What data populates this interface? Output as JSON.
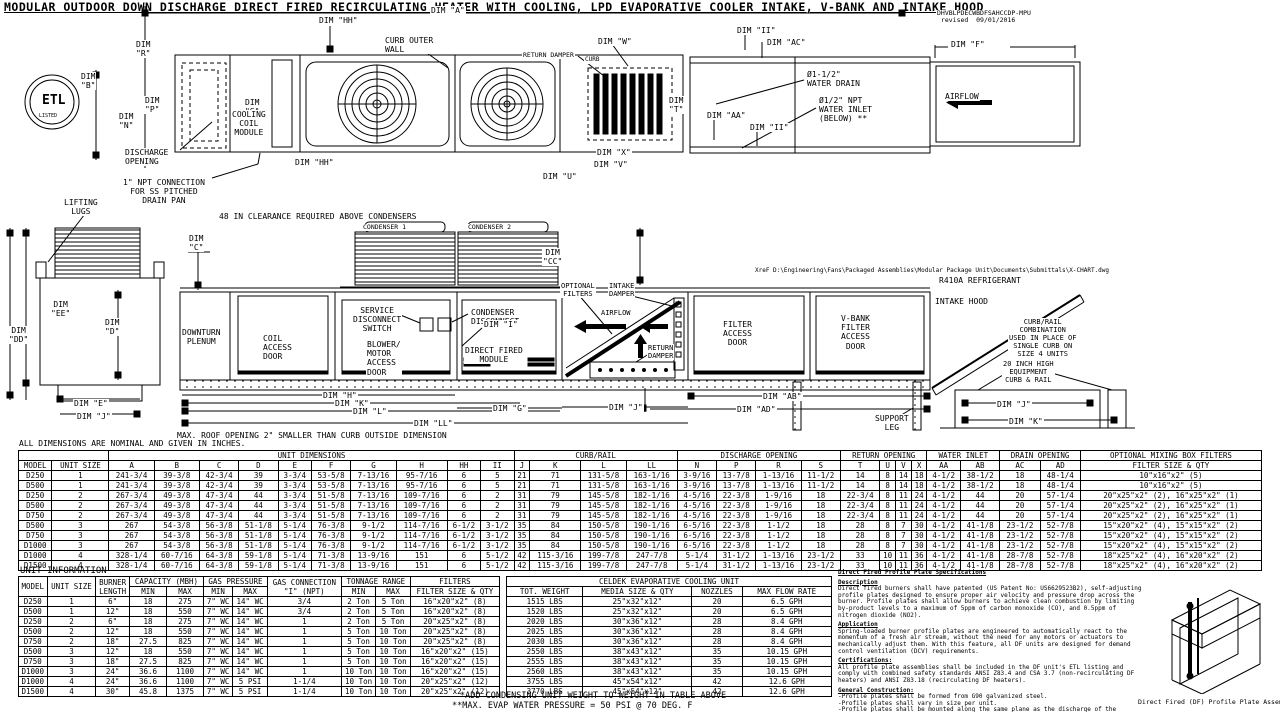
{
  "title": "MODULAR OUTDOOR DOWN DISCHARGE DIRECT FIRED RECIRCULATING HEATER WITH COOLING, LPD EVAPORATIVE COOLER INTAKE, V-BANK AND INTAKE HOOD",
  "labels": [
    {
      "k": "drawing-number",
      "t": "DHVBLPDECWBDFSAHCCDP-MPU\n revised  09/01/2016",
      "x": 936,
      "y": 10,
      "fs": 6.5
    },
    {
      "k": "dim-hh-top-label",
      "t": "DIM \"HH\"",
      "x": 318,
      "y": 16
    },
    {
      "k": "dim-a-label",
      "t": "DIM \"A\"",
      "x": 430,
      "y": 6
    },
    {
      "k": "curb-outer-wall-label",
      "t": "CURB OUTER\nWALL",
      "x": 384,
      "y": 36
    },
    {
      "k": "return-damper-plan-label",
      "t": "RETURN DAMPER",
      "x": 522,
      "y": 52,
      "fs": 6.5
    },
    {
      "k": "curb-small-label",
      "t": "CURB",
      "x": 584,
      "y": 57,
      "fs": 6
    },
    {
      "k": "dim-w-label",
      "t": "DIM \"W\"",
      "x": 597,
      "y": 37
    },
    {
      "k": "dim-r-label",
      "c": "ctr",
      "t": "DIM\n\"R\"",
      "x": 135,
      "y": 40
    },
    {
      "k": "dim-b-label",
      "c": "ctr",
      "t": "DIM\n\"B\"",
      "x": 80,
      "y": 72
    },
    {
      "k": "dim-s-label",
      "c": "ctr",
      "t": "DIM\n\"S\"",
      "x": 244,
      "y": 98
    },
    {
      "k": "dim-p-label",
      "c": "ctr",
      "t": "DIM\n\"P\"",
      "x": 144,
      "y": 96
    },
    {
      "k": "dim-n-label",
      "c": "ctr",
      "t": "DIM\n\"N\"",
      "x": 118,
      "y": 112
    },
    {
      "k": "cooling-coil-module-label",
      "c": "ctr",
      "t": "COOLING\nCOIL\nMODULE",
      "x": 231,
      "y": 110
    },
    {
      "k": "discharge-opening-label",
      "t": "DISCHARGE\nOPENING",
      "x": 124,
      "y": 148
    },
    {
      "k": "dim-hh-mid-label",
      "t": "DIM \"HH\"",
      "x": 294,
      "y": 158
    },
    {
      "k": "npt-connection-label",
      "c": "ctr",
      "t": "1\" NPT CONNECTION\nFOR SS PITCHED\nDRAIN PAN",
      "x": 122,
      "y": 178
    },
    {
      "k": "dim-t-label",
      "c": "ctr",
      "t": "DIM\n\"T\"",
      "x": 668,
      "y": 96
    },
    {
      "k": "dim-x-label",
      "t": "DIM \"X\"",
      "x": 596,
      "y": 148
    },
    {
      "k": "dim-v-label",
      "t": "DIM \"V\"",
      "x": 593,
      "y": 160
    },
    {
      "k": "dim-u-label",
      "t": "DIM \"U\"",
      "x": 542,
      "y": 172
    },
    {
      "k": "dim-ii-1-label",
      "t": "DIM \"II\"",
      "x": 736,
      "y": 26
    },
    {
      "k": "dim-ac-label",
      "t": "DIM \"AC\"",
      "x": 766,
      "y": 38
    },
    {
      "k": "water-drain-label",
      "t": "Ø1-1/2\"\nWATER DRAIN",
      "x": 806,
      "y": 70
    },
    {
      "k": "water-inlet-label",
      "t": "Ø1/2\" NPT\nWATER INLET\n(BELOW) **",
      "x": 818,
      "y": 96
    },
    {
      "k": "dim-aa-label",
      "t": "DIM \"AA\"",
      "x": 706,
      "y": 111
    },
    {
      "k": "dim-ii-2-label",
      "t": "DIM \"II\"",
      "x": 749,
      "y": 123
    },
    {
      "k": "dim-f-label",
      "t": "DIM \"F\"",
      "x": 950,
      "y": 40
    },
    {
      "k": "airflow-plan-label",
      "t": "AIRFLOW",
      "x": 944,
      "y": 92
    },
    {
      "k": "etl-mark-text",
      "c": "ctr nobg b",
      "t": "ETL",
      "x": 41,
      "y": 94,
      "fs": 13
    },
    {
      "k": "etl-listed-text",
      "c": "ctr nobg",
      "t": "LISTED",
      "x": 38,
      "y": 114,
      "fs": 5
    },
    {
      "k": "lifting-lugs-label",
      "c": "ctr",
      "t": "LIFTING\nLUGS",
      "x": 63,
      "y": 198
    },
    {
      "k": "clearance-note",
      "t": "48 IN CLEARANCE REQUIRED ABOVE CONDENSERS",
      "x": 218,
      "y": 212
    },
    {
      "k": "condenser-1-label",
      "t": "CONDENSER 1",
      "x": 362,
      "y": 224,
      "fs": 6.5
    },
    {
      "k": "condenser-2-label",
      "t": "CONDENSER 2",
      "x": 467,
      "y": 224,
      "fs": 6.5
    },
    {
      "k": "dim-c-label",
      "c": "ctr",
      "t": "DIM\n\"C\"",
      "x": 188,
      "y": 234
    },
    {
      "k": "dim-cc-label",
      "c": "ctr",
      "t": "DIM\n\"CC\"",
      "x": 542,
      "y": 248
    },
    {
      "k": "dim-ee-label",
      "c": "ctr",
      "t": "DIM\n\"EE\"",
      "x": 50,
      "y": 300
    },
    {
      "k": "dim-dd-label",
      "c": "ctr",
      "t": "DIM\n\"DD\"",
      "x": 8,
      "y": 326
    },
    {
      "k": "dim-d-label",
      "c": "ctr",
      "t": "DIM\n\"D\"",
      "x": 104,
      "y": 318
    },
    {
      "k": "downturn-plenum-label",
      "c": "ctr",
      "t": "DOWNTURN\nPLENUM",
      "x": 181,
      "y": 328
    },
    {
      "k": "coil-access-door-label",
      "t": "COIL\nACCESS\nDOOR",
      "x": 262,
      "y": 334
    },
    {
      "k": "service-disconnect-label",
      "c": "ctr",
      "t": "SERVICE\nDISCONNECT\nSWITCH",
      "x": 352,
      "y": 306
    },
    {
      "k": "condenser-disconnect-label",
      "t": "CONDENSER\nDISCONNECT",
      "x": 470,
      "y": 308
    },
    {
      "k": "blower-motor-door-label",
      "t": "BLOWER/\nMOTOR\nACCESS\nDOOR",
      "x": 366,
      "y": 340
    },
    {
      "k": "dim-i-label",
      "t": "DIM \"I\"",
      "x": 483,
      "y": 320
    },
    {
      "k": "direct-fired-module-label",
      "c": "ctr",
      "t": "DIRECT FIRED\nMODULE",
      "x": 464,
      "y": 346
    },
    {
      "k": "optional-filters-label",
      "c": "ctr",
      "t": "OPTIONAL\nFILTERS",
      "x": 560,
      "y": 282,
      "fs": 7
    },
    {
      "k": "intake-damper-label",
      "c": "ctr",
      "t": "INTAKE\nDAMPER",
      "x": 608,
      "y": 282,
      "fs": 7
    },
    {
      "k": "airflow-elev-label",
      "c": "nobg",
      "t": "AIRFLOW",
      "x": 600,
      "y": 309,
      "fs": 7
    },
    {
      "k": "return-damper-elev-label",
      "c": "ctr",
      "t": "RETURN\nDAMPER",
      "x": 647,
      "y": 344,
      "fs": 7
    },
    {
      "k": "filter-access-door-label",
      "c": "ctr",
      "t": "FILTER\nACCESS\nDOOR",
      "x": 722,
      "y": 320
    },
    {
      "k": "vbank-door-label",
      "c": "ctr",
      "t": "V-BANK\nFILTER\nACCESS\nDOOR",
      "x": 840,
      "y": 314
    },
    {
      "k": "xref-path",
      "t": "XreF D:\\Engineering\\Fans\\Packaged Assemblies\\Modular Package Unit\\Documents\\Submittals\\X-CHART.dwg",
      "x": 754,
      "y": 268,
      "fs": 6
    },
    {
      "k": "refrigerant-label",
      "t": "R410A REFRIGERANT",
      "x": 938,
      "y": 276
    },
    {
      "k": "intake-hood-label",
      "t": "INTAKE HOOD",
      "x": 934,
      "y": 297
    },
    {
      "k": "curb-rail-combo-note",
      "c": "ctr",
      "t": "CURB/RAIL\nCOMBINATION\nUSED IN PLACE OF\nSINGLE CURB ON\nSIZE 4 UNITS",
      "x": 1008,
      "y": 318,
      "fs": 7
    },
    {
      "k": "equipment-curb-label",
      "c": "ctr",
      "t": "20 INCH HIGH\nEQUIPMENT\nCURB & RAIL",
      "x": 1002,
      "y": 360,
      "fs": 7
    },
    {
      "k": "dim-e-label",
      "t": "DIM \"E\"",
      "x": 73,
      "y": 399
    },
    {
      "k": "dim-j-end-label",
      "t": "DIM \"J\"",
      "x": 76,
      "y": 412
    },
    {
      "k": "dim-h-label",
      "t": "DIM \"H\"",
      "x": 322,
      "y": 391
    },
    {
      "k": "dim-k-label",
      "t": "DIM \"K\"",
      "x": 334,
      "y": 399
    },
    {
      "k": "dim-l-label",
      "t": "DIM \"L\"",
      "x": 352,
      "y": 407
    },
    {
      "k": "dim-ll-label",
      "t": "DIM \"LL\"",
      "x": 413,
      "y": 419
    },
    {
      "k": "dim-g-label",
      "t": "DIM \"G\"",
      "x": 492,
      "y": 404
    },
    {
      "k": "dim-j-mid-label",
      "t": "DIM \"J\"",
      "x": 608,
      "y": 403
    },
    {
      "k": "dim-ab-label",
      "t": "DIM \"AB\"",
      "x": 762,
      "y": 392
    },
    {
      "k": "dim-ad-label",
      "t": "DIM \"AD\"",
      "x": 736,
      "y": 405
    },
    {
      "k": "support-leg-label",
      "c": "ctr",
      "t": "SUPPORT\nLEG",
      "x": 874,
      "y": 414
    },
    {
      "k": "dim-j-curb-label",
      "t": "DIM \"J\"",
      "x": 996,
      "y": 400
    },
    {
      "k": "dim-k-curb-label",
      "t": "DIM \"K\"",
      "x": 1008,
      "y": 417
    },
    {
      "k": "max-roof-note",
      "t": "MAX. ROOF OPENING 2\" SMALLER THAN CURB OUTSIDE DIMENSION",
      "x": 176,
      "y": 431
    },
    {
      "k": "all-dims-note",
      "t": "ALL DIMENSIONS ARE NOMINAL AND GIVEN IN INCHES.",
      "x": 18,
      "y": 439
    }
  ],
  "dim_table": {
    "group_unit": "UNIT DIMENSIONS",
    "group_curb": "CURB/RAIL",
    "group_discharge": "DISCHARGE OPENING",
    "group_return": "RETURN OPENING",
    "group_water": "WATER INLET",
    "group_drain": "DRAIN OPENING",
    "group_filters": "OPTIONAL MIXING BOX FILTERS",
    "header_row": [
      "MODEL",
      "UNIT SIZE",
      "A",
      "B",
      "C",
      "D",
      "E",
      "F",
      "G",
      "H",
      "HH",
      "II",
      "J",
      "K",
      "L",
      "LL",
      "N",
      "P",
      "R",
      "S",
      "T",
      "U",
      "V",
      "X",
      "AA",
      "AB",
      "AC",
      "AD",
      "FILTER SIZE & QTY"
    ],
    "rows": [
      [
        "D250",
        "1",
        "241-3/4",
        "39-3/8",
        "42-3/4",
        "39",
        "3-3/4",
        "53-5/8",
        "7-13/16",
        "95-7/16",
        "6",
        "5",
        "21",
        "71",
        "131-5/8",
        "163-1/16",
        "3-9/16",
        "13-7/8",
        "1-13/16",
        "11-1/2",
        "14",
        "8",
        "14",
        "18",
        "4-1/2",
        "38-1/2",
        "18",
        "48-1/4",
        "10\"x16\"x2\" (5)"
      ],
      [
        "D500",
        "1",
        "241-3/4",
        "39-3/8",
        "42-3/4",
        "39",
        "3-3/4",
        "53-5/8",
        "7-13/16",
        "95-7/16",
        "6",
        "5",
        "21",
        "71",
        "131-5/8",
        "163-1/16",
        "3-9/16",
        "13-7/8",
        "1-13/16",
        "11-1/2",
        "14",
        "8",
        "14",
        "18",
        "4-1/2",
        "38-1/2",
        "18",
        "48-1/4",
        "10\"x16\"x2\" (5)"
      ],
      [
        "D250",
        "2",
        "267-3/4",
        "49-3/8",
        "47-3/4",
        "44",
        "3-3/4",
        "51-5/8",
        "7-13/16",
        "109-7/16",
        "6",
        "2",
        "31",
        "79",
        "145-5/8",
        "182-1/16",
        "4-5/16",
        "22-3/8",
        "1-9/16",
        "18",
        "22-3/4",
        "8",
        "11",
        "24",
        "4-1/2",
        "44",
        "20",
        "57-1/4",
        "20\"x25\"x2\" (2), 16\"x25\"x2\" (1)"
      ],
      [
        "D500",
        "2",
        "267-3/4",
        "49-3/8",
        "47-3/4",
        "44",
        "3-3/4",
        "51-5/8",
        "7-13/16",
        "109-7/16",
        "6",
        "2",
        "31",
        "79",
        "145-5/8",
        "182-1/16",
        "4-5/16",
        "22-3/8",
        "1-9/16",
        "18",
        "22-3/4",
        "8",
        "11",
        "24",
        "4-1/2",
        "44",
        "20",
        "57-1/4",
        "20\"x25\"x2\" (2), 16\"x25\"x2\" (1)"
      ],
      [
        "D750",
        "2",
        "267-3/4",
        "49-3/8",
        "47-3/4",
        "44",
        "3-3/4",
        "51-5/8",
        "7-13/16",
        "109-7/16",
        "6",
        "2",
        "31",
        "79",
        "145-5/8",
        "182-1/16",
        "4-5/16",
        "22-3/8",
        "1-9/16",
        "18",
        "22-3/4",
        "8",
        "11",
        "24",
        "4-1/2",
        "44",
        "20",
        "57-1/4",
        "20\"x25\"x2\" (2), 16\"x25\"x2\" (1)"
      ],
      [
        "D500",
        "3",
        "267",
        "54-3/8",
        "56-3/8",
        "51-1/8",
        "5-1/4",
        "76-3/8",
        "9-1/2",
        "114-7/16",
        "6-1/2",
        "3-1/2",
        "35",
        "84",
        "150-5/8",
        "190-1/16",
        "6-5/16",
        "22-3/8",
        "1-1/2",
        "18",
        "28",
        "8",
        "7",
        "30",
        "4-1/2",
        "41-1/8",
        "23-1/2",
        "52-7/8",
        "15\"x20\"x2\" (4), 15\"x15\"x2\" (2)"
      ],
      [
        "D750",
        "3",
        "267",
        "54-3/8",
        "56-3/8",
        "51-1/8",
        "5-1/4",
        "76-3/8",
        "9-1/2",
        "114-7/16",
        "6-1/2",
        "3-1/2",
        "35",
        "84",
        "150-5/8",
        "190-1/16",
        "6-5/16",
        "22-3/8",
        "1-1/2",
        "18",
        "28",
        "8",
        "7",
        "30",
        "4-1/2",
        "41-1/8",
        "23-1/2",
        "52-7/8",
        "15\"x20\"x2\" (4), 15\"x15\"x2\" (2)"
      ],
      [
        "D1000",
        "3",
        "267",
        "54-3/8",
        "56-3/8",
        "51-1/8",
        "5-1/4",
        "76-3/8",
        "9-1/2",
        "114-7/16",
        "6-1/2",
        "3-1/2",
        "35",
        "84",
        "150-5/8",
        "190-1/16",
        "6-5/16",
        "22-3/8",
        "1-1/2",
        "18",
        "28",
        "8",
        "7",
        "30",
        "4-1/2",
        "41-1/8",
        "23-1/2",
        "52-7/8",
        "15\"x20\"x2\" (4), 15\"x15\"x2\" (2)"
      ],
      [
        "D1000",
        "4",
        "328-1/4",
        "60-7/16",
        "64-3/8",
        "59-1/8",
        "5-1/4",
        "71-3/8",
        "13-9/16",
        "151",
        "6",
        "5-1/2",
        "42",
        "115-3/16",
        "199-7/8",
        "247-7/8",
        "5-1/4",
        "31-1/2",
        "1-13/16",
        "23-1/2",
        "33",
        "10",
        "11",
        "36",
        "4-1/2",
        "41-1/8",
        "28-7/8",
        "52-7/8",
        "18\"x25\"x2\" (4), 16\"x20\"x2\" (2)"
      ],
      [
        "D1500",
        "4",
        "328-1/4",
        "60-7/16",
        "64-3/8",
        "59-1/8",
        "5-1/4",
        "71-3/8",
        "13-9/16",
        "151",
        "6",
        "5-1/2",
        "42",
        "115-3/16",
        "199-7/8",
        "247-7/8",
        "5-1/4",
        "31-1/2",
        "1-13/16",
        "23-1/2",
        "33",
        "10",
        "11",
        "36",
        "4-1/2",
        "41-1/8",
        "28-7/8",
        "52-7/8",
        "18\"x25\"x2\" (4), 16\"x20\"x2\" (2)"
      ]
    ]
  },
  "unit_info": {
    "title": "UNIT INFORMATION",
    "col_model": "MODEL",
    "col_unit_size": "UNIT SIZE",
    "col_burner": "BURNER\nLENGTH",
    "grp_capacity": "CAPACITY (MBH)",
    "grp_gas_pressure": "GAS PRESSURE",
    "col_gas_conn": "GAS CONNECTION\n\"I\" (NPT)",
    "grp_tonnage": "TONNAGE RANGE",
    "grp_filters": "FILTERS",
    "sub_min": "MIN",
    "sub_max": "MAX",
    "col_filter_size": "FILTER SIZE & QTY",
    "rows": [
      [
        "D250",
        "1",
        "6\"",
        "18",
        "275",
        "7\" WC",
        "14\" WC",
        "3/4",
        "2 Ton",
        "5 Ton",
        "16\"x20\"x2\" (8)"
      ],
      [
        "D500",
        "1",
        "12\"",
        "18",
        "550",
        "7\" WC",
        "14\" WC",
        "3/4",
        "2 Ton",
        "5 Ton",
        "16\"x20\"x2\" (8)"
      ],
      [
        "D250",
        "2",
        "6\"",
        "18",
        "275",
        "7\" WC",
        "14\" WC",
        "1",
        "2 Ton",
        "5 Ton",
        "20\"x25\"x2\" (8)"
      ],
      [
        "D500",
        "2",
        "12\"",
        "18",
        "550",
        "7\" WC",
        "14\" WC",
        "1",
        "5 Ton",
        "10 Ton",
        "20\"x25\"x2\" (8)"
      ],
      [
        "D750",
        "2",
        "18\"",
        "27.5",
        "825",
        "7\" WC",
        "14\" WC",
        "1",
        "5 Ton",
        "10 Ton",
        "20\"x25\"x2\" (8)"
      ],
      [
        "D500",
        "3",
        "12\"",
        "18",
        "550",
        "7\" WC",
        "14\" WC",
        "1",
        "5 Ton",
        "10 Ton",
        "16\"x20\"x2\" (15)"
      ],
      [
        "D750",
        "3",
        "18\"",
        "27.5",
        "825",
        "7\" WC",
        "14\" WC",
        "1",
        "5 Ton",
        "10 Ton",
        "16\"x20\"x2\" (15)"
      ],
      [
        "D1000",
        "3",
        "24\"",
        "36.6",
        "1100",
        "7\" WC",
        "14\" WC",
        "1",
        "10 Ton",
        "10 Ton",
        "16\"x20\"x2\" (15)"
      ],
      [
        "D1000",
        "4",
        "24\"",
        "36.6",
        "1100",
        "7\" WC",
        "5 PSI",
        "1-1/4",
        "10 Ton",
        "10 Ton",
        "20\"x25\"x2\" (12)"
      ],
      [
        "D1500",
        "4",
        "30\"",
        "45.8",
        "1375",
        "7\" WC",
        "5 PSI",
        "1-1/4",
        "10 Ton",
        "10 Ton",
        "20\"x25\"x2\" (12)"
      ]
    ]
  },
  "celdek": {
    "title": "CELDEK EVAPORATIVE COOLING UNIT",
    "header_row": [
      "TOT. WEIGHT",
      "MEDIA SIZE & QTY",
      "NOZZLES",
      "MAX FLOW RATE"
    ],
    "rows": [
      [
        "1515 LBS",
        "25\"x32\"x12\"",
        "20",
        "6.5 GPH"
      ],
      [
        "1520 LBS",
        "25\"x32\"x12\"",
        "20",
        "6.5 GPH"
      ],
      [
        "2020 LBS",
        "30\"x36\"x12\"",
        "28",
        "8.4 GPH"
      ],
      [
        "2025 LBS",
        "30\"x36\"x12\"",
        "28",
        "8.4 GPH"
      ],
      [
        "2030 LBS",
        "30\"x36\"x12\"",
        "28",
        "8.4 GPH"
      ],
      [
        "2550 LBS",
        "38\"x43\"x12\"",
        "35",
        "10.15 GPH"
      ],
      [
        "2555 LBS",
        "38\"x43\"x12\"",
        "35",
        "10.15 GPH"
      ],
      [
        "2560 LBS",
        "38\"x43\"x12\"",
        "35",
        "10.15 GPH"
      ],
      [
        "3755 LBS",
        "45\"x54\"x12\"",
        "42",
        "12.6 GPH"
      ],
      [
        "3770 LBS",
        "45\"x54\"x12\"",
        "42",
        "12.6 GPH"
      ]
    ]
  },
  "notes": {
    "add_condensing": "*ADD CONDENSING UNIT WEIGHT TO WEIGHT IN TABLE ABOVE",
    "max_evap": "**MAX. EVAP WATER PRESSURE = 50 PSI @ 70 DEG. F"
  },
  "specs": {
    "heading": "Direct Fired Profile Plate Specifications",
    "desc_heading": "Description",
    "desc_text": "Direct fired burners shall have patented (US Patent No: US6629523B2), self-adjusting profile plates designed to ensure proper air velocity and pressure drop across the burner. Profile plates shall allow burners to achieve clean combustion by limiting by-product levels to a maximum of 5ppm of carbon monoxide (CO), and 0.5ppm of nitrogen dioxide (NO2).",
    "app_heading": "Application",
    "app_text": "Spring-loaded burner profile plates are engineered to automatically react to the momentum of a fresh air stream, without the need for any motors or actuators to mechanically adjust them. With this feature, all DF units are designed for demand control ventilation (DCV) requirements.",
    "cert_heading": "Certifications:",
    "cert_text": "All profile plate assemblies shall be included in the DF unit's ETL listing and comply with combined safety standards ANSI Z83.4 and CSA 3.7 (non-recirculating DF heaters) and ANSI Z83.18 (recirculating DF heaters).",
    "gen_heading": "General Construction:",
    "gen_items": [
      "-Profile plates shall be formed from G90 galvanized steel.",
      "-Profile plates shall vary in size per unit.",
      "-Profile plates shall be mounted along the same plane as the discharge of the burner.",
      "-Design shall incorporate properly torqued, permanently mounted spring hinges.",
      "-Spring hinges shall be made from plated steel."
    ],
    "iso_caption": "Direct Fired (DF) Profile Plate Assembly"
  }
}
